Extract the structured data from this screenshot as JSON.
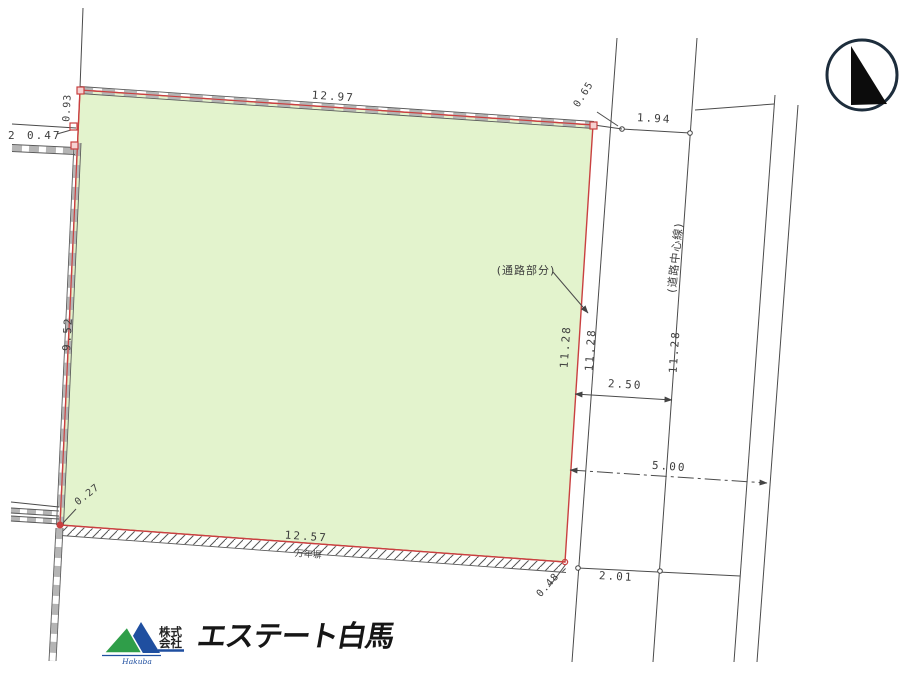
{
  "drawing": {
    "dims": {
      "top": "12.97",
      "left": "9.52",
      "left_upper": "0.93",
      "left_offset_prefix": "2",
      "left_offset": "0.47",
      "top_right_gap": "1.94",
      "corner_top_right": "0.65",
      "strip_len_1": "11.28",
      "strip_len_2": "11.28",
      "strip_len_3": "11.28",
      "road_half_width": "2.50",
      "road_full_width": "5.00",
      "bottom_right_gap": "2.01",
      "corner_bottom_right": "0.48",
      "corner_bottom_left": "0.27",
      "bottom": "12.57"
    },
    "notes": {
      "road_part": "(通路部分)",
      "road_center_line": "(道路中心線)",
      "fence": "万年塀"
    },
    "colors": {
      "parcel_fill": "#e3f3cd",
      "boundary": "#c94040",
      "line": "#4b4b4b"
    }
  },
  "compass": {
    "icon": "north-arrow"
  },
  "logo": {
    "prefix_line1": "株式",
    "prefix_line2": "会社",
    "company_name": "エステート白馬",
    "script_name": "Hakuba"
  }
}
